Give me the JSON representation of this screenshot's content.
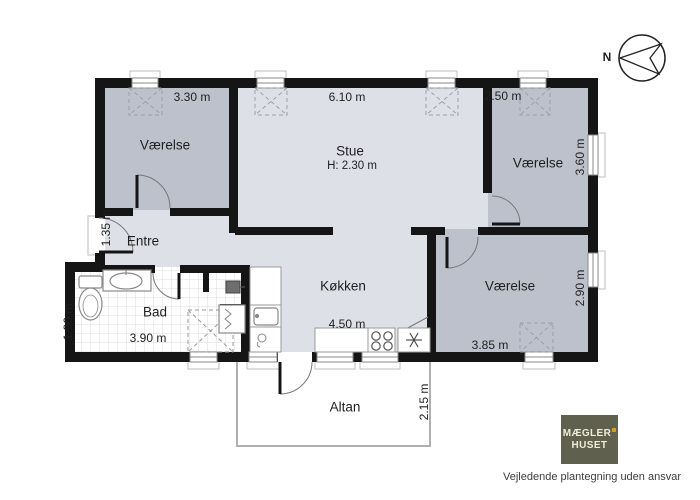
{
  "plan": {
    "rooms": {
      "bedroom_top_left": {
        "name": "Værelse",
        "width": "3.30 m"
      },
      "stue": {
        "name": "Stue",
        "ceiling_height": "H: 2.30 m",
        "width": "6.10 m"
      },
      "bedroom_top_right": {
        "name": "Værelse",
        "width": "2.50 m",
        "depth": "3.60 m"
      },
      "entre": {
        "name": "Entre",
        "depth": "1.35 m"
      },
      "bad": {
        "name": "Bad",
        "width": "3.90 m",
        "depth": "1.90 m"
      },
      "koekken": {
        "name": "Køkken",
        "width": "4.50 m"
      },
      "bedroom_bottom_right": {
        "name": "Værelse",
        "width": "3.85 m",
        "depth": "2.90 m"
      },
      "altan": {
        "name": "Altan",
        "depth": "2.15 m"
      }
    },
    "fixture_icons": [
      "toilet-icon",
      "bath-sink-icon",
      "shower-icon",
      "washing-machine-icon",
      "water-heater-icon",
      "kitchen-sink-icon",
      "dishwasher-icon",
      "stove-icon",
      "freezer-icon"
    ],
    "colors": {
      "wall": "#151515",
      "bedroom_fill": "#bcc1cb",
      "living_fill": "#dde1e7",
      "bath_fill": "#ffffff",
      "tile_line": "#dcdcdc",
      "altan_border": "#b0b0b0"
    }
  },
  "compass": {
    "label": "N"
  },
  "branding": {
    "logo_line1": "MÆGLER",
    "logo_line2": "HUSET",
    "logo_bg": "#5f604e",
    "logo_accent": "#d79a2b",
    "disclaimer": "Vejledende plantegning uden ansvar"
  }
}
